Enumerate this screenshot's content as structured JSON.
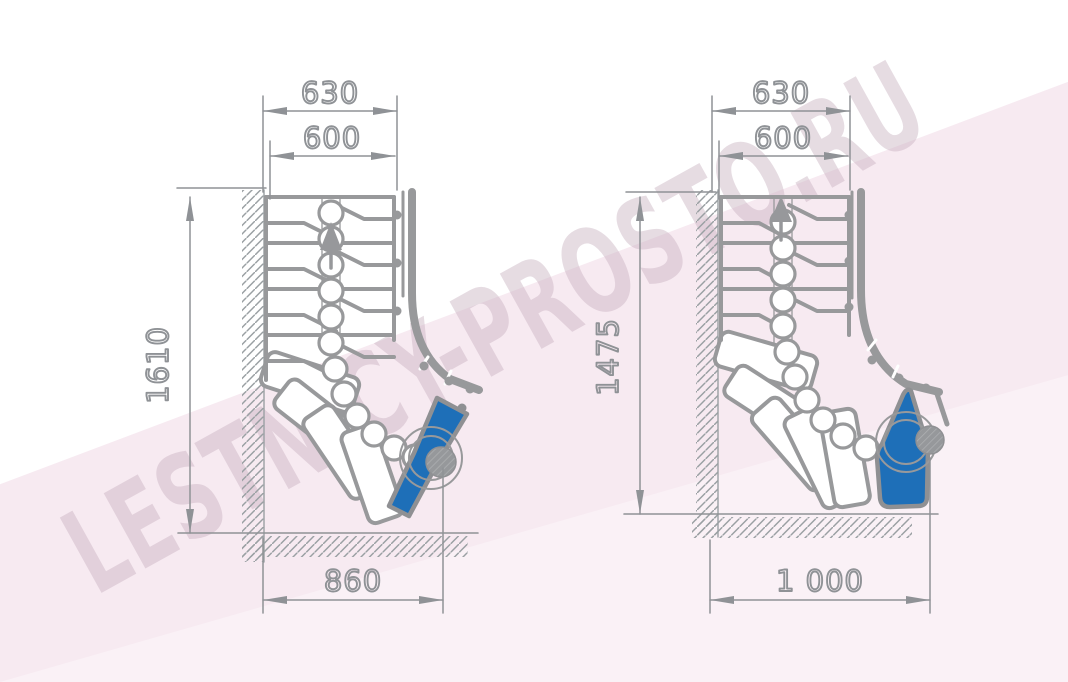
{
  "watermark": {
    "text": "LESTNICY-PROSTO.RU"
  },
  "colors": {
    "accent_blue": "#1e6fb8",
    "line_gray": "#98999b",
    "dim_gray": "#8f9296",
    "background_pink": "#f7eaf1"
  },
  "diagrams": {
    "left": {
      "title": "staircase-90-turn-plan-variant-1",
      "dims": {
        "overall_width": "630",
        "clear_width": "600",
        "height": "1610",
        "turn_width": "860"
      }
    },
    "right": {
      "title": "staircase-90-turn-plan-variant-2",
      "dims": {
        "overall_width": "630",
        "clear_width": "600",
        "height": "1475",
        "turn_width": "1 000"
      }
    }
  }
}
